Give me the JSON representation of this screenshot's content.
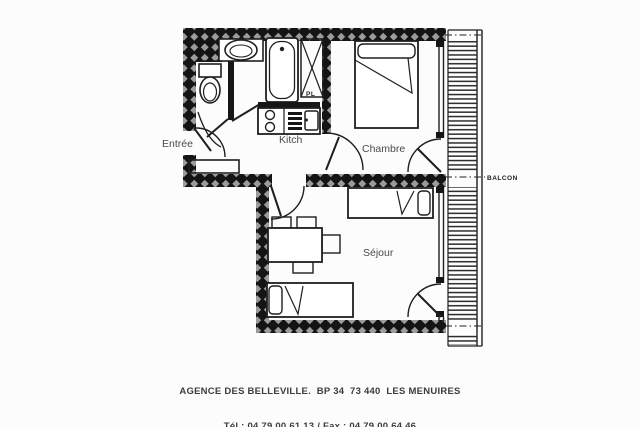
{
  "plan": {
    "title": "apartment-floor-plan",
    "rooms": {
      "entree": "Entrée",
      "kitchen": "Kitch",
      "bedroom": "Chambre",
      "living": "Séjour",
      "balcony": "BALCON",
      "closet": "PL"
    },
    "fixtures": {
      "toilet": "toilet",
      "washbasin": "washbasin",
      "bathtub": "bathtub",
      "kitchenette": "kitchenette (2 burners, grill, sink)",
      "wardrobe": "wardrobe",
      "double_bed": "double bed",
      "single_bed_top": "single bed",
      "single_bed_bottom": "single bed",
      "dining_table": "dining table with 4 chairs"
    },
    "colors": {
      "wall": "#161616",
      "wall_hatch_diamond": "#9b9b9b",
      "line": "#1f1f1f",
      "label": "#4a4a4a",
      "background": "#fcfcfc"
    }
  },
  "footer": {
    "line1": "AGENCE DES BELLEVILLE.  BP 34  73 440  LES MENUIRES",
    "line2": "Tél : 04.79.00.61.13 / Fax : 04.79.00.64.46"
  }
}
